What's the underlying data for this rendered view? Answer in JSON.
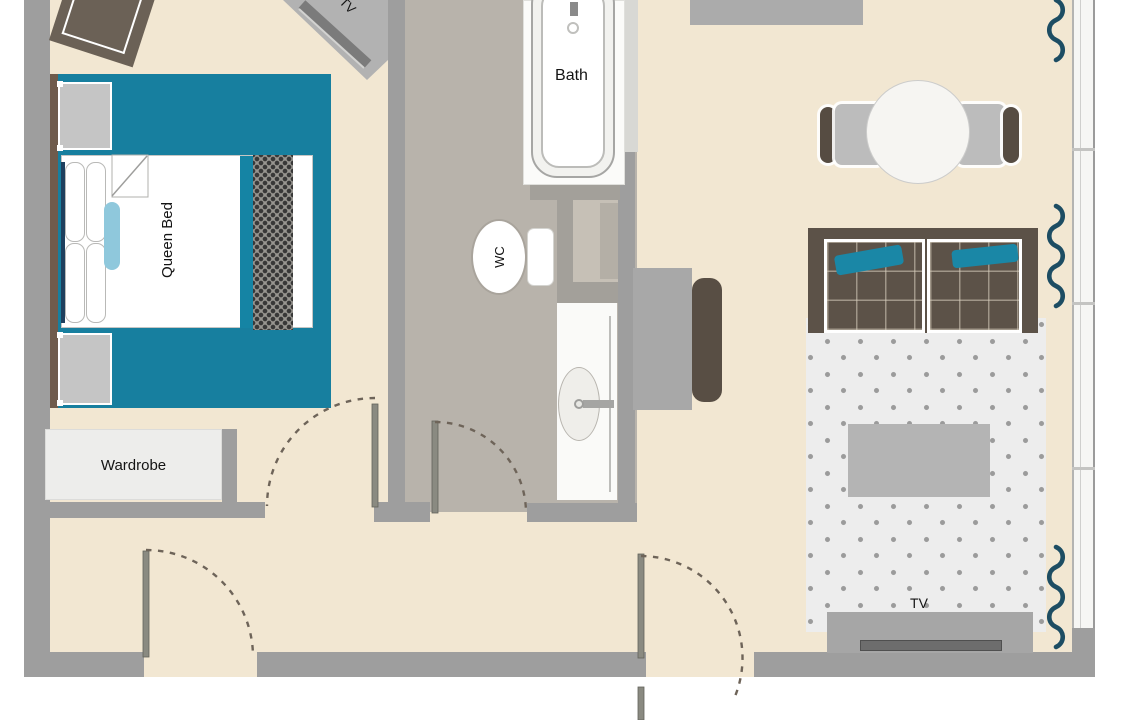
{
  "title": "Apartment floor plan",
  "labels": {
    "queen_bed": "Queen Bed",
    "wardrobe": "Wardrobe",
    "bath": "Bath",
    "wc": "WC",
    "bedroom_tv": "TV",
    "living_tv": "TV"
  },
  "colors": {
    "accent_teal": "#177f9f",
    "accent_light_blue": "#8fc8dc",
    "curtain_navy": "#1d4d63",
    "wall_gray": "#9e9e9e",
    "floor_beige": "#f2e7d2",
    "bathroom_floor_taupe": "#b8b3ab",
    "wood_brown": "#6f5b4c",
    "sofa_brown": "#5c5248",
    "rug_light": "#ededed"
  }
}
